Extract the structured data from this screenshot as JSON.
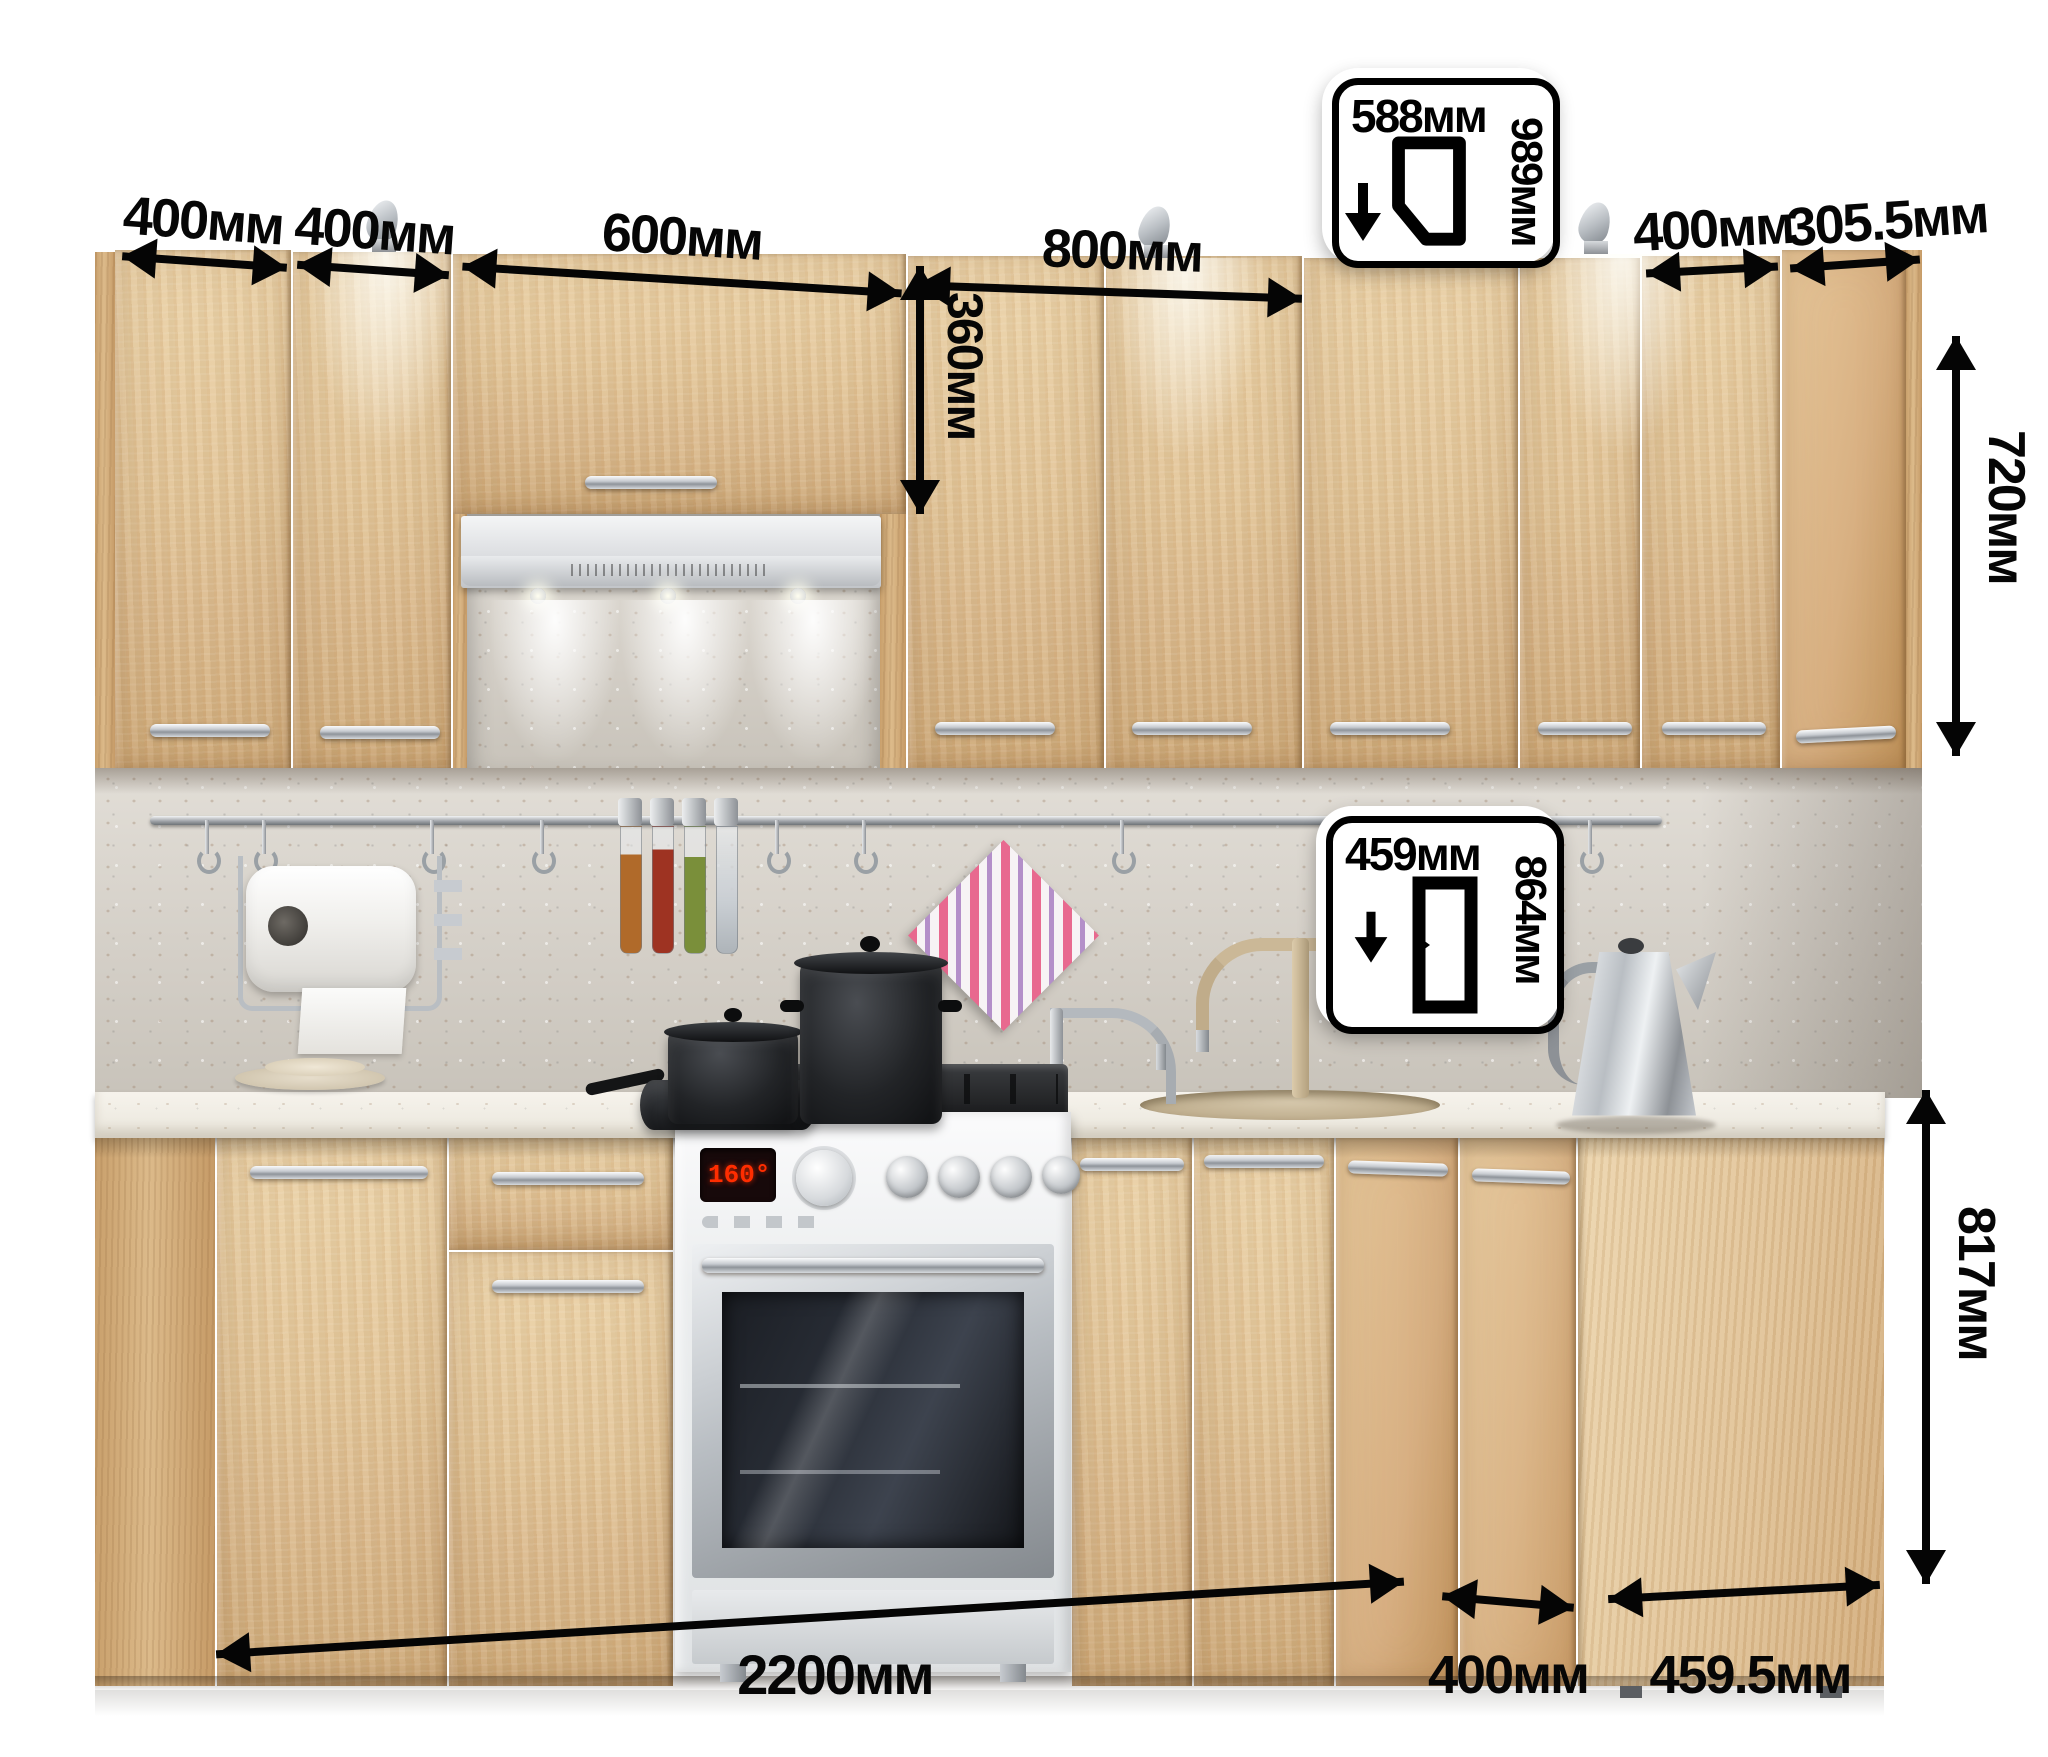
{
  "units": "мм",
  "dimensions": {
    "upper_row": [
      "400мм",
      "400мм",
      "600мм",
      "800мм",
      "400мм",
      "305.5мм"
    ],
    "hood_door_height": "360мм",
    "upper_height": "720мм",
    "base_height": "817мм",
    "base_run": "2200мм",
    "base_corner_door": "400мм",
    "base_side_depth": "459.5мм"
  },
  "badges": {
    "wall_corner": {
      "width": "588мм",
      "height": "989мм"
    },
    "base_corner": {
      "width": "459мм",
      "height": "864мм"
    }
  },
  "appliances": {
    "stove_display": "160°"
  },
  "colors": {
    "wood": "#e3c597",
    "wood_dark": "#c9a06c",
    "counter": "#f2efe7",
    "backsplash": "#d9d5ce",
    "arrow": "#050505",
    "towel_pink": "#e8698f",
    "towel_violet": "#b48fc9",
    "steel": "#c7cbd0",
    "display_red": "#ff2d00"
  }
}
